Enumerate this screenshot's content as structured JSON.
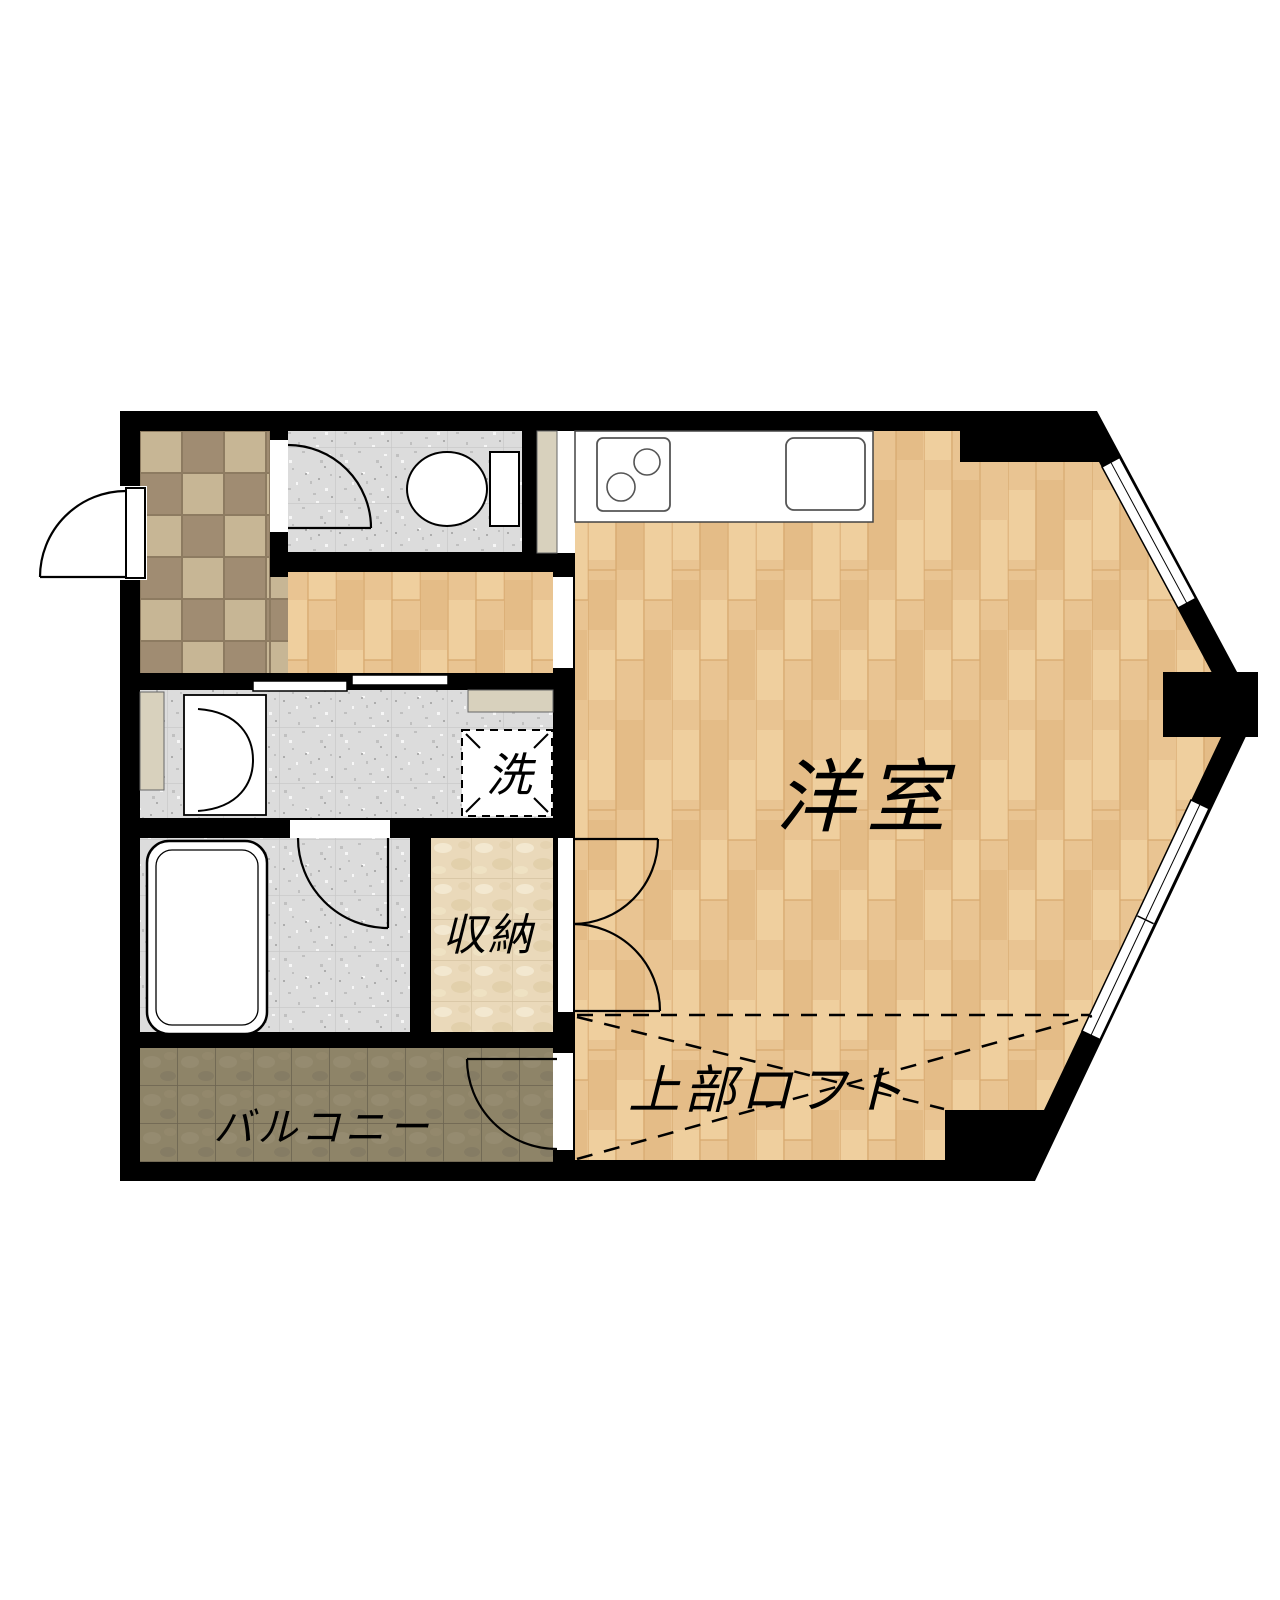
{
  "plan": {
    "type": "apartment-floor-plan",
    "labels": {
      "western_room": "洋室",
      "loft": "上部ロフト",
      "storage": "収納",
      "laundry": "洗",
      "balcony": "バルコニー"
    },
    "rooms": [
      {
        "label": "洋室",
        "meaning": "western-style room",
        "floor": "light wood planks"
      },
      {
        "label": "上部ロフト",
        "meaning": "loft above (dashed outline)",
        "floor": "light wood planks"
      },
      {
        "label": "収納",
        "meaning": "storage closet",
        "floor": "beige marble tile"
      },
      {
        "label": "洗",
        "meaning": "washing machine space",
        "floor": "white, dashed box"
      },
      {
        "label": "バルコニー",
        "meaning": "balcony",
        "floor": "dark brown tile"
      }
    ],
    "unlabeled_areas": [
      "entrance-genkan-checker-tile",
      "toilet-room",
      "hallway-wood",
      "washroom-gray-tile",
      "bathroom-with-tub",
      "kitchen-open-corner"
    ],
    "fixtures": [
      "entrance-door-swing",
      "toilet",
      "toilet-tank",
      "toilet-door-swing",
      "kitchen-counter",
      "stove-two-burner",
      "kitchen-sink",
      "sliding-door-two-panels",
      "washbasin-vanity",
      "bathtub",
      "bath-door-swing",
      "storage-double-door",
      "balcony-door-swing",
      "bay-window-upper",
      "bay-window-lower",
      "loft-dashed-boundary",
      "cabinet-strip-left",
      "cabinet-shelf-washroom",
      "cabinet-strip-toilet"
    ],
    "colors": {
      "wall": "#000000",
      "wood": "#e9c492",
      "wood_line": "#d8a96f",
      "gray_tile": "#dcdcdc",
      "checker_light": "#c7b695",
      "checker_dark": "#a08c72",
      "marble": "#ead9ba",
      "balcony_tile": "#8e8468",
      "cabinet": "#d8d1bd",
      "line": "#000000"
    }
  }
}
